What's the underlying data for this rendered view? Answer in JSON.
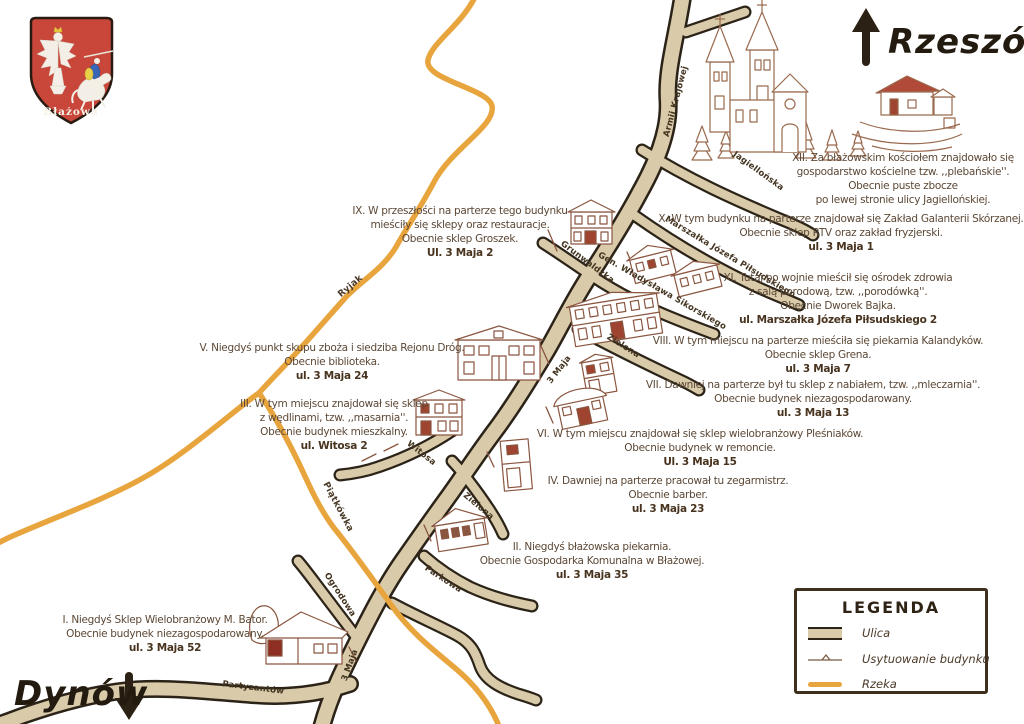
{
  "coat_of_arms": {
    "town": "Błażowa"
  },
  "directions": {
    "north": {
      "label": "Rzeszów"
    },
    "south": {
      "label": "Dynów"
    }
  },
  "legend": {
    "title": "LEGENDA",
    "items": [
      {
        "key": "street",
        "label": "Ulica"
      },
      {
        "key": "building-location",
        "label": "Usytuowanie budynku"
      },
      {
        "key": "river",
        "label": "Rzeka"
      }
    ]
  },
  "streets": {
    "armii_krajowej": "Armii Krajowej",
    "jagiellonska": "Jagiellońska",
    "pilsudskiego": "Marszałka Józefa Piłsudskiego",
    "grunwaldzka": "Grunwaldzka",
    "sikorskiego": "Gen. Władysława Sikorskiego",
    "zielona": "Zielona",
    "maja3": "3 Maja",
    "witosa": "Witosa",
    "parkowa": "Parkowa",
    "ogrodowa": "Ogrodowa",
    "partyzantow": "Partyzantów"
  },
  "rivers": {
    "ryjak": "Ryjak",
    "piatkowka": "Piątkówka"
  },
  "annotations": [
    {
      "numeral": "I",
      "lines": [
        "I. Niegdyś Sklep Wielobranżowy M. Bator.",
        "Obecnie budynek niezagospodarowany."
      ],
      "address": "ul. 3 Maja 52"
    },
    {
      "numeral": "II",
      "lines": [
        "II. Niegdyś błażowska piekarnia.",
        "Obecnie Gospodarka Komunalna w Błażowej."
      ],
      "address": "ul. 3 Maja 35"
    },
    {
      "numeral": "III",
      "lines": [
        "III. W tym miejscu znajdował się sklep",
        "z wędlinami, tzw. ,,masarnia''.",
        "Obecnie budynek mieszkalny."
      ],
      "address": "ul. Witosa 2"
    },
    {
      "numeral": "IV",
      "lines": [
        "IV. Dawniej na parterze pracował tu zegarmistrz.",
        "Obecnie barber."
      ],
      "address": "ul. 3 Maja 23"
    },
    {
      "numeral": "V",
      "lines": [
        "V. Niegdyś punkt skupu zboża i siedziba Rejonu Dróg.",
        "Obecnie biblioteka."
      ],
      "address": "ul. 3 Maja 24"
    },
    {
      "numeral": "VI",
      "lines": [
        "VI. W tym miejscu znajdował się sklep wielobranżowy Pleśniaków.",
        "Obecnie budynek w remoncie."
      ],
      "address": "Ul. 3 Maja 15"
    },
    {
      "numeral": "VII",
      "lines": [
        "VII. Dawniej na parterze był tu sklep z nabiałem, tzw. ,,mleczarnia''.",
        "Obecnie budynek niezagospodarowany."
      ],
      "address": "ul. 3 Maja 13"
    },
    {
      "numeral": "VIII",
      "lines": [
        "VIII. W tym miejscu na parterze mieściła się piekarnia Kalandyków.",
        "Obecnie sklep Grena."
      ],
      "address": "ul. 3 Maja 7"
    },
    {
      "numeral": "IX",
      "lines": [
        "IX. W przeszłości na parterze tego budynku",
        "mieściły się sklepy oraz restauracje.",
        "Obecnie sklep Groszek."
      ],
      "address": "Ul. 3 Maja 2"
    },
    {
      "numeral": "X",
      "lines": [
        "X. W tym budynku na parterze znajdował się Zakład Galanterii Skórzanej.",
        "Obecnie sklep RTV oraz zakład fryzjerski."
      ],
      "address": "ul. 3 Maja 1"
    },
    {
      "numeral": "XI",
      "lines": [
        "XI. Tutaj po wojnie mieścił się ośrodek zdrowia",
        "z salą porodową, tzw. ,,porodówką''.",
        "Obecnie Dworek Bajka."
      ],
      "address": "ul. Marszałka Józefa Piłsudskiego 2"
    },
    {
      "numeral": "XII",
      "lines": [
        "XII. Za błażowskim kościołem znajdowało się",
        "gospodarstwo kościelne tzw. ,,plebańskie''.",
        "Obecnie puste zbocze",
        "po lewej stronie ulicy Jagiellońskiej."
      ],
      "address": ""
    }
  ],
  "colors": {
    "road_fill": "#d9caaa",
    "road_outline": "#2b2317",
    "river": "#e8a53e",
    "ink": "#5c4836",
    "sketch": "#9a6a4e"
  }
}
